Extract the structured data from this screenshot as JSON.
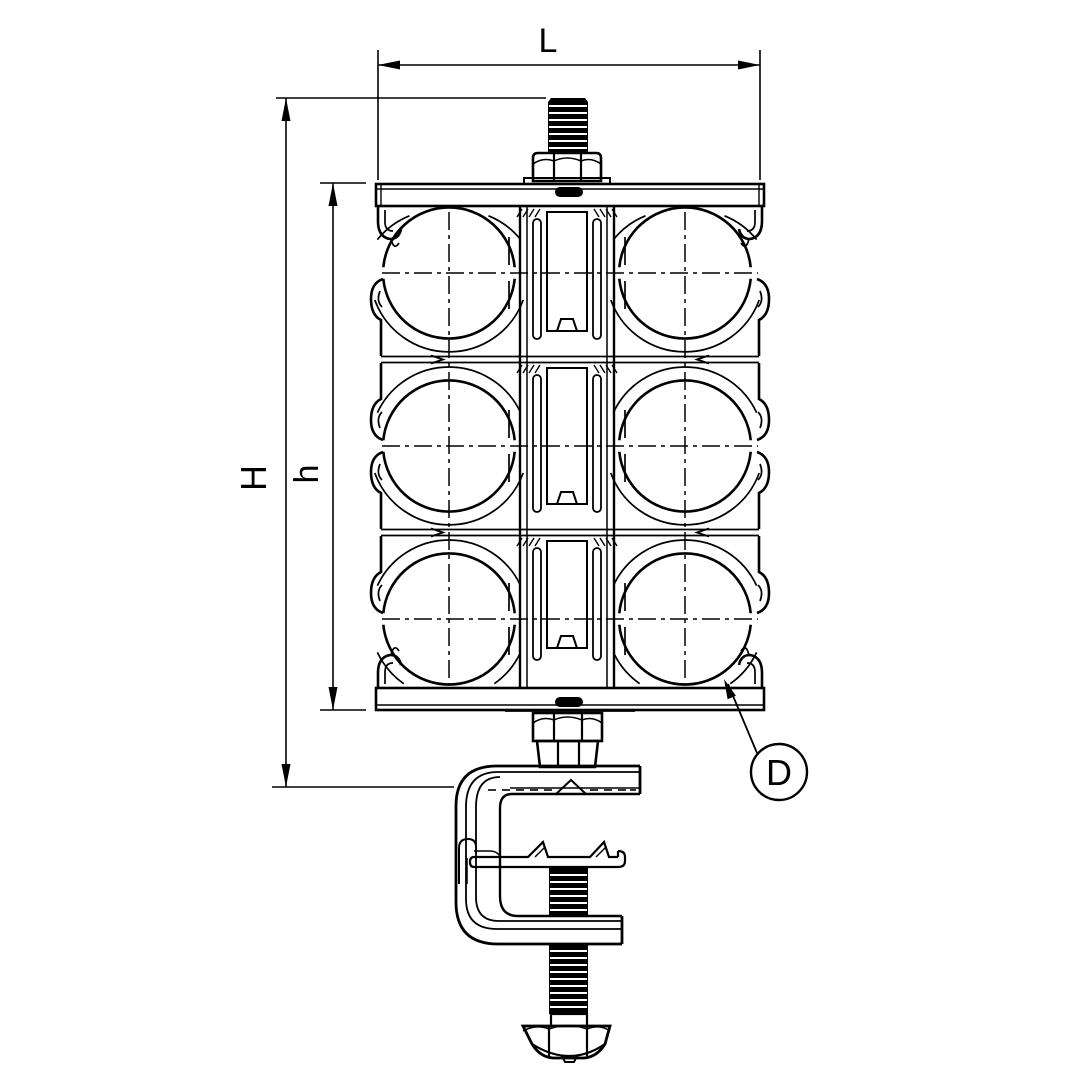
{
  "drawing": {
    "type": "technical-line-drawing",
    "description": "Side elevation of a stacked multi-cable cleat assembly (3 cable rows x 2 columns) mounted on a central threaded stud, clamped between a top plate and bottom plate, fastened with hex nuts to a G-type beam clamp with a threaded screw and hex bolt head",
    "background_color": "#ffffff",
    "line_color": "#000000",
    "labels": {
      "width_dimension": "L",
      "overall_height_dimension": "H",
      "stack_height_dimension": "h",
      "detail_callout": "D"
    }
  }
}
